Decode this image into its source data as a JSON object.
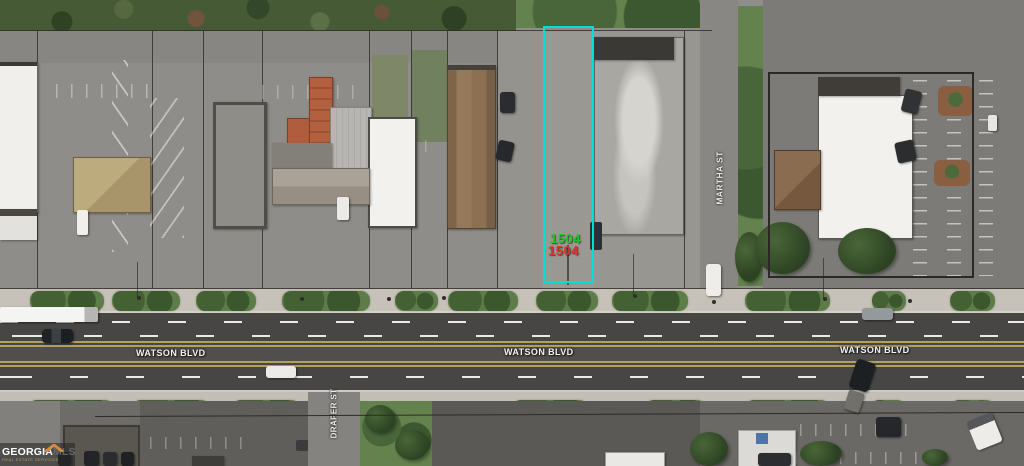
{
  "map": {
    "streets": {
      "watson_blvd": "WATSON BLVD",
      "martha_st": "MARTHA ST",
      "draper_st": "DRAPER ST"
    },
    "highlighted_parcel": {
      "labels": [
        {
          "text": "1504",
          "color": "#1ECB1E"
        },
        {
          "text": "1504",
          "color": "#E2342A"
        }
      ],
      "outline_color": "#00E0D8"
    },
    "watermark": {
      "brand_primary": "GEORGIA",
      "brand_secondary": "MLS",
      "tagline": "REAL ESTATE SERVICES",
      "roof_icon_color": "#D98A3D"
    }
  }
}
